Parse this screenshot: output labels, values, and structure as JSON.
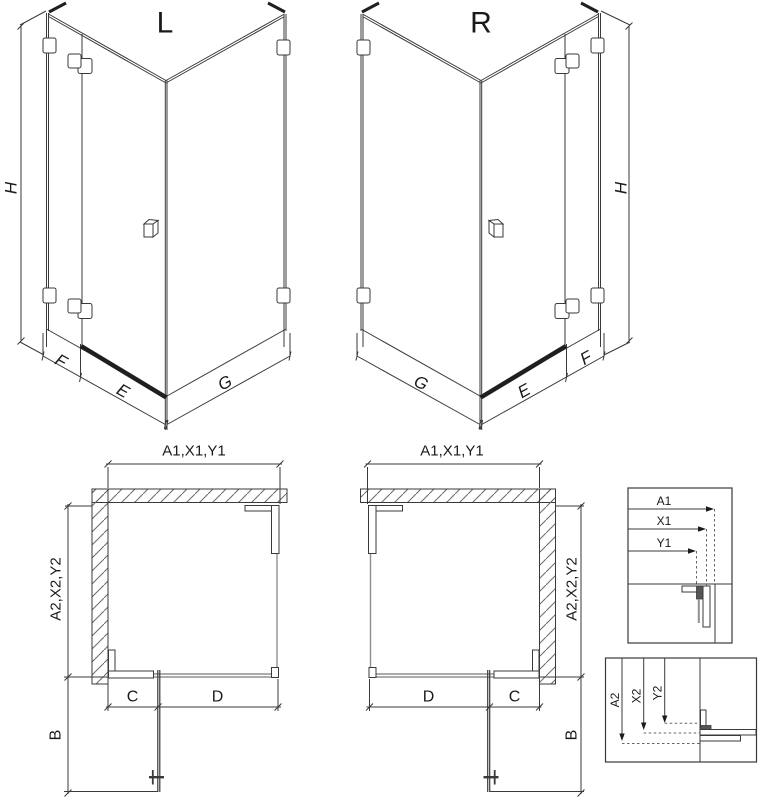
{
  "drawing": {
    "isometric_left": {
      "title": "L",
      "dim_height": "H",
      "dim_fixed": "F",
      "dim_door": "E",
      "dim_side": "G"
    },
    "isometric_right": {
      "title": "R",
      "dim_height": "H",
      "dim_fixed": "F",
      "dim_door": "E",
      "dim_side": "G"
    },
    "plan_left": {
      "dim_top": "A1,X1,Y1",
      "dim_side": "A2,X2,Y2",
      "dim_c": "C",
      "dim_d": "D",
      "dim_b": "B"
    },
    "plan_right": {
      "dim_top": "A1,X1,Y1",
      "dim_side": "A2,X2,Y2",
      "dim_c": "C",
      "dim_d": "D",
      "dim_b": "B"
    },
    "detail_width": {
      "rows": [
        {
          "label": "A1"
        },
        {
          "label": "X1"
        },
        {
          "label": "Y1"
        }
      ]
    },
    "detail_depth": {
      "rows": [
        {
          "label": "A2"
        },
        {
          "label": "X2"
        },
        {
          "label": "Y2"
        }
      ]
    },
    "colors": {
      "line": "#3a3a3a",
      "glass_line": "#909090",
      "dark_accent": "#1f1f1f",
      "hatch": "#6a6a6a",
      "text": "#1a1a1a",
      "background": "#ffffff"
    }
  }
}
